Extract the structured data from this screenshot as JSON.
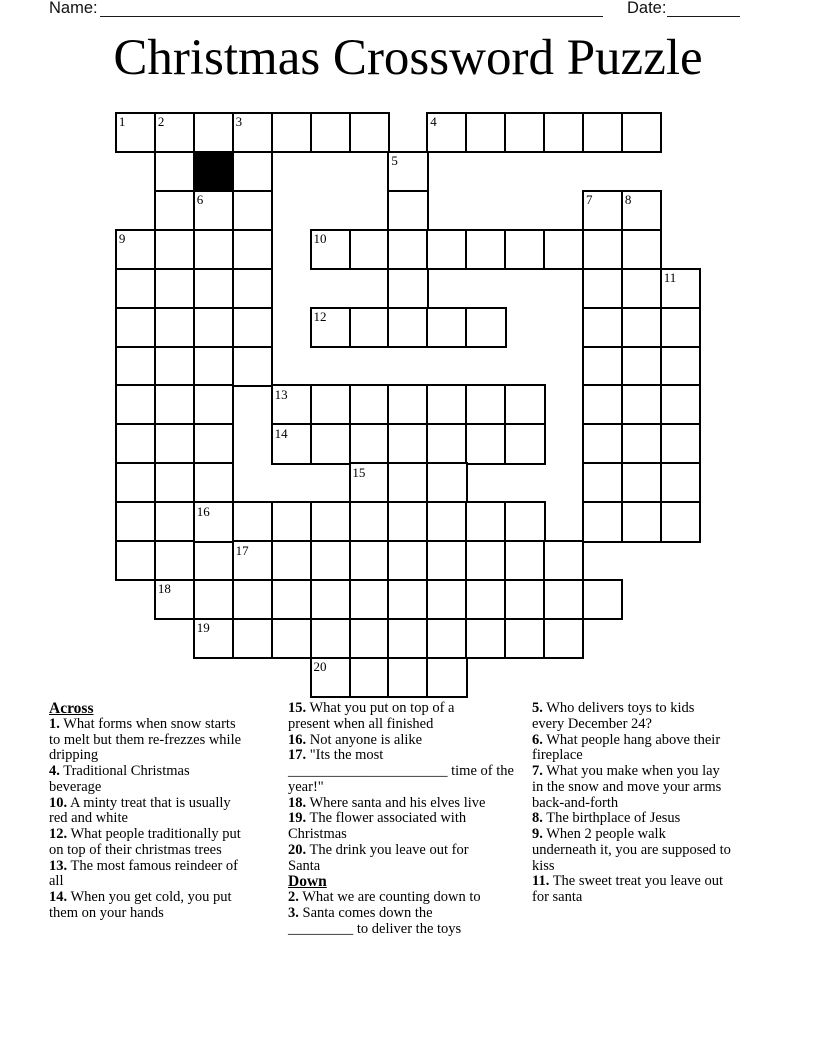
{
  "header": {
    "name_label": "Name:",
    "date_label": "Date:"
  },
  "title": "Christmas Crossword Puzzle",
  "grid": {
    "rows": [
      "OOOOOOO.OOOOOO.",
      ".O#O...O.......",
      ".OOO...O....OO.",
      "OOOO.OOOOOOOOO.",
      "OOOO...O....OOO",
      "OOOO.OOOOO..OOO",
      "OOOO........OOO",
      "OOO.OOOOOOO.OOO",
      "OOO.OOOOOOO.OOO",
      "OOO...OOO...OOO",
      "OOOOOOOOOOO.OOO",
      "OO.OOOOOOOOO...",
      ".OOOOOOOOOOOO..",
      "..OOOOOOOOOO...",
      ".....OOOO......"
    ],
    "numbers": [
      {
        "n": "1",
        "r": 0,
        "c": 0
      },
      {
        "n": "2",
        "r": 0,
        "c": 1
      },
      {
        "n": "3",
        "r": 0,
        "c": 3
      },
      {
        "n": "4",
        "r": 0,
        "c": 8
      },
      {
        "n": "5",
        "r": 1,
        "c": 7
      },
      {
        "n": "6",
        "r": 2,
        "c": 2
      },
      {
        "n": "7",
        "r": 2,
        "c": 12
      },
      {
        "n": "8",
        "r": 2,
        "c": 13
      },
      {
        "n": "9",
        "r": 3,
        "c": 0
      },
      {
        "n": "10",
        "r": 3,
        "c": 5
      },
      {
        "n": "11",
        "r": 4,
        "c": 14
      },
      {
        "n": "12",
        "r": 5,
        "c": 5
      },
      {
        "n": "13",
        "r": 7,
        "c": 4
      },
      {
        "n": "14",
        "r": 8,
        "c": 4
      },
      {
        "n": "15",
        "r": 9,
        "c": 6
      },
      {
        "n": "16",
        "r": 10,
        "c": 2
      },
      {
        "n": "17",
        "r": 11,
        "c": 3
      },
      {
        "n": "18",
        "r": 12,
        "c": 1
      },
      {
        "n": "19",
        "r": 13,
        "c": 2
      },
      {
        "n": "20",
        "r": 14,
        "c": 5
      }
    ]
  },
  "clue_columns": [
    [
      {
        "header": "Across"
      },
      {
        "n": "1.",
        "text": "What forms when snow starts\nto melt but them re-frezzes while\ndripping"
      },
      {
        "n": "4.",
        "text": "Traditional Christmas\nbeverage"
      },
      {
        "n": "10.",
        "text": "A minty treat that is usually\nred and white"
      },
      {
        "n": "12.",
        "text": "What people traditionally put\non top of their christmas trees"
      },
      {
        "n": "13.",
        "text": "The most famous reindeer of\nall"
      },
      {
        "n": "14.",
        "text": "When you get cold, you put\nthem on your hands"
      }
    ],
    [
      {
        "n": "15.",
        "text": "What you put on top of a\npresent when all finished"
      },
      {
        "n": "16.",
        "text": "Not anyone is alike"
      },
      {
        "n": "17.",
        "text": "\"Its the most\n______________________ time of the\nyear!\""
      },
      {
        "n": "18.",
        "text": "Where santa and his elves live"
      },
      {
        "n": "19.",
        "text": "The flower associated with\nChristmas"
      },
      {
        "n": "20.",
        "text": "The drink you leave out for\nSanta"
      },
      {
        "header": "Down"
      },
      {
        "n": "2.",
        "text": "What we are counting down to"
      },
      {
        "n": "3.",
        "text": "Santa comes down the\n_________ to deliver the toys"
      }
    ],
    [
      {
        "n": "5.",
        "text": "Who delivers toys to kids\nevery December 24?"
      },
      {
        "n": "6.",
        "text": "What people hang above their\nfireplace"
      },
      {
        "n": "7.",
        "text": "What you make when you lay\nin the snow and move your arms\nback-and-forth"
      },
      {
        "n": "8.",
        "text": "The birthplace of Jesus"
      },
      {
        "n": "9.",
        "text": "When 2 people walk\nunderneath it, you are supposed to\nkiss"
      },
      {
        "n": "11.",
        "text": "The sweet treat you leave out\nfor santa"
      }
    ]
  ]
}
